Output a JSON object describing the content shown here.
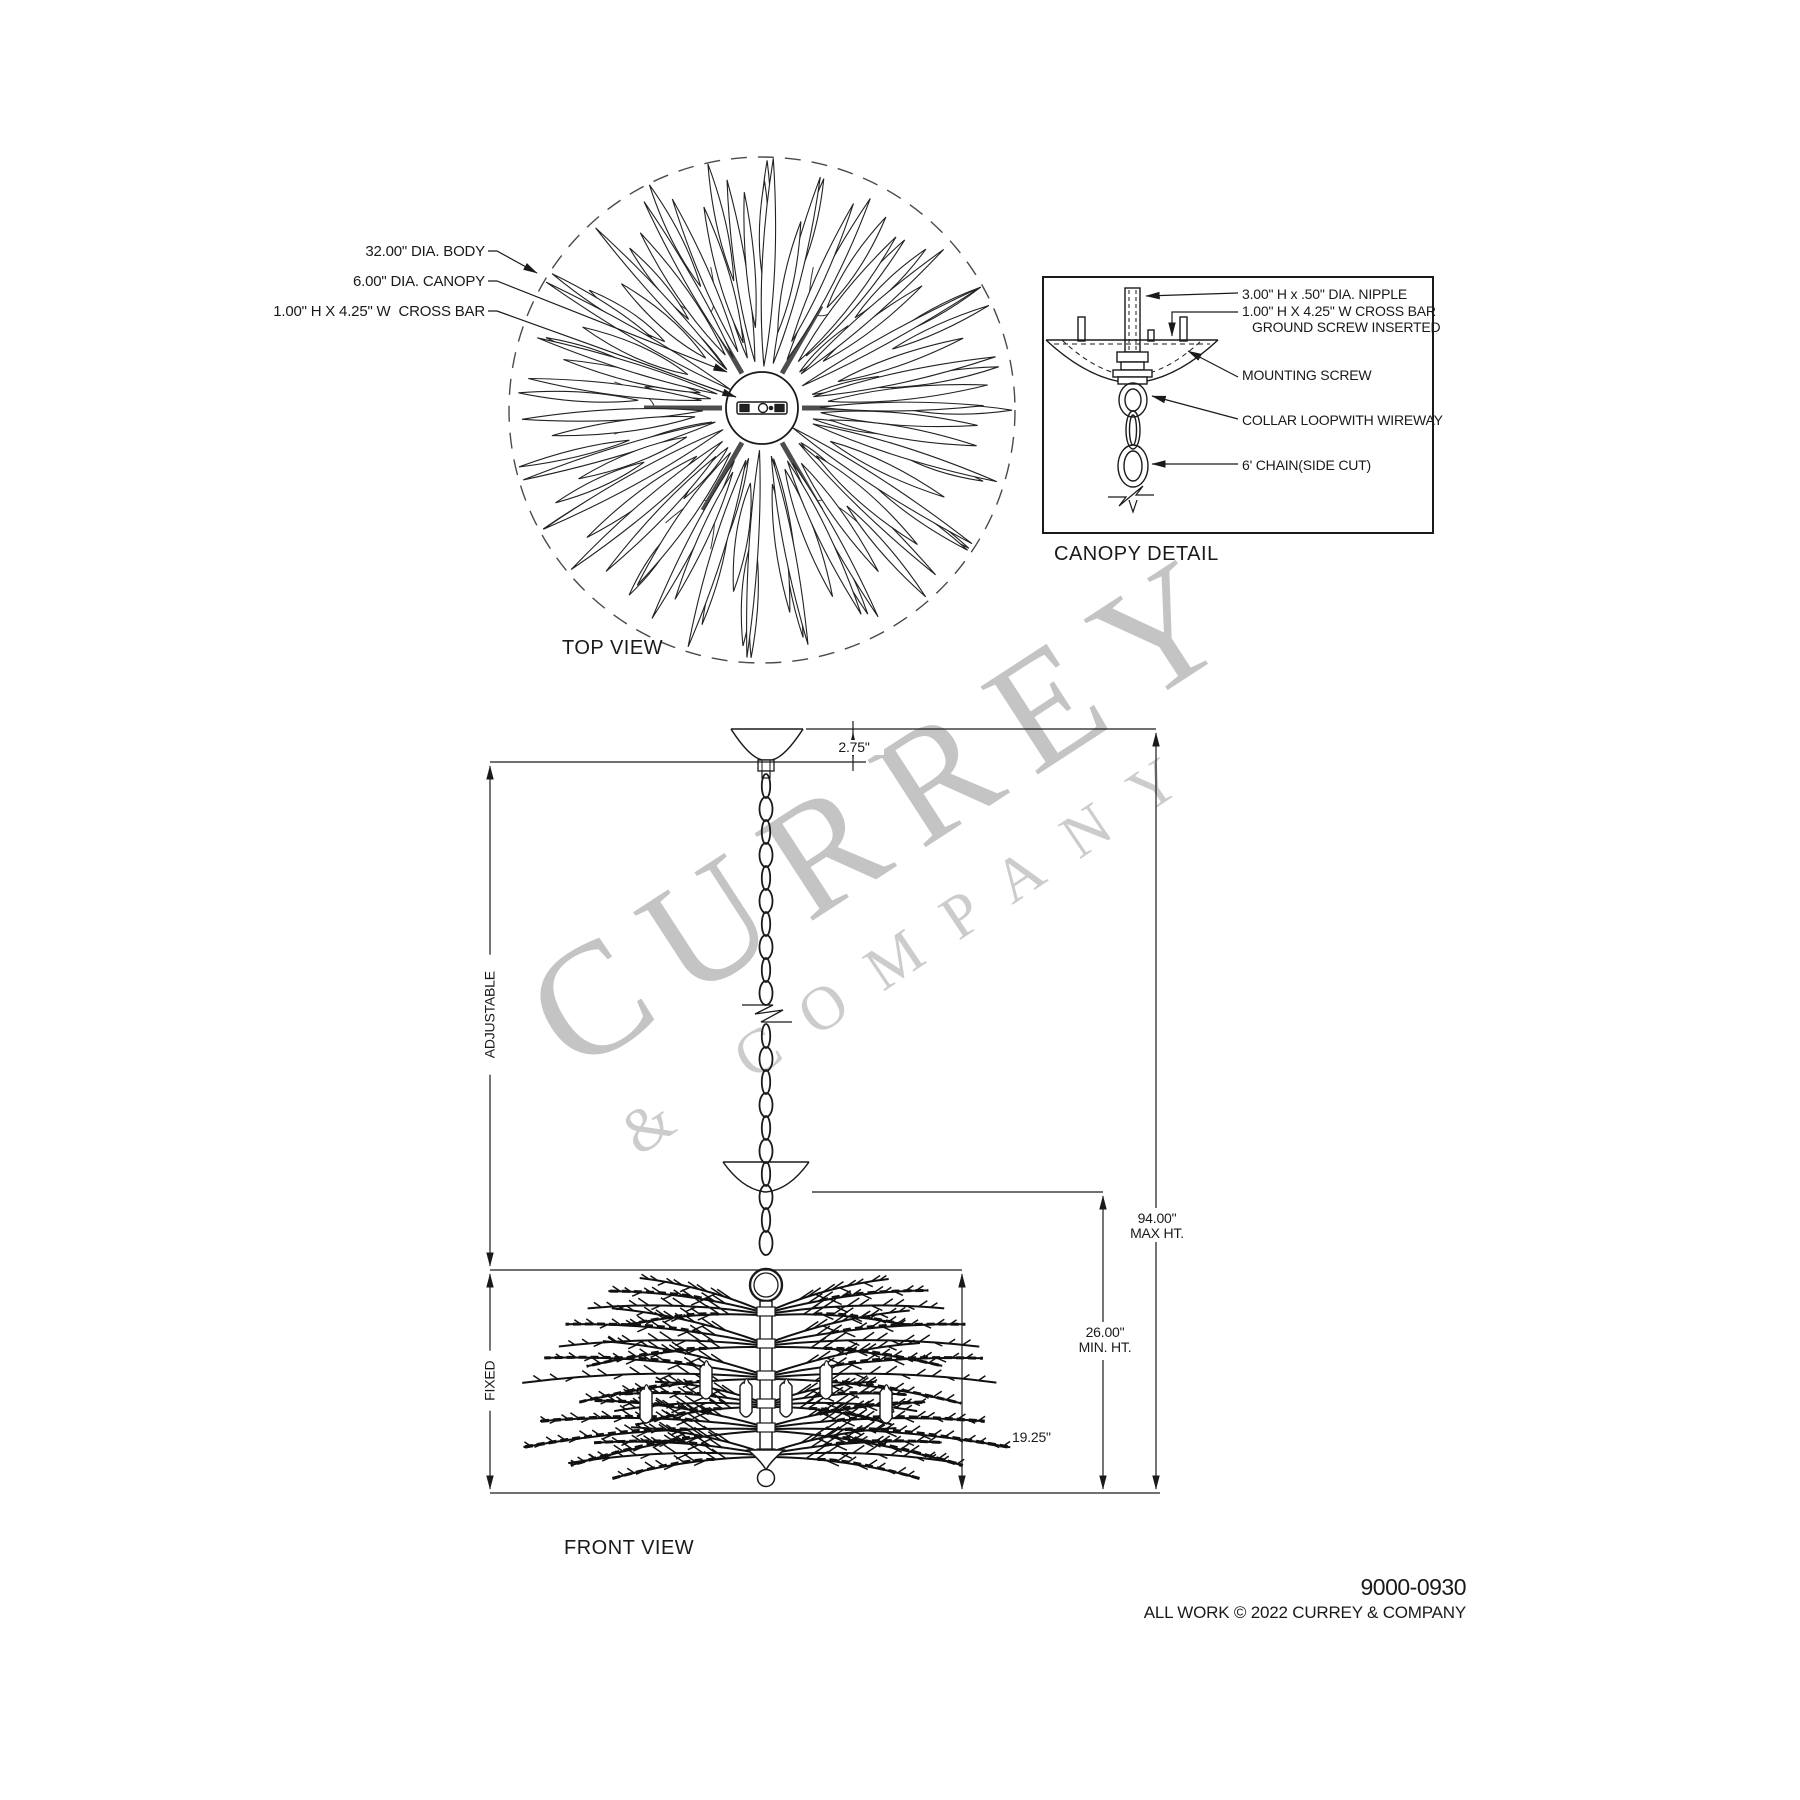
{
  "watermark": {
    "line1": "CURREY",
    "line2": "& COMPANY"
  },
  "top_view": {
    "title": "TOP VIEW",
    "label_body": "32.00\" DIA. BODY",
    "label_canopy": "6.00\" DIA. CANOPY",
    "label_crossbar": "1.00\" H X 4.25\" W  CROSS BAR"
  },
  "canopy_detail": {
    "title": "CANOPY DETAIL",
    "label_nipple": "3.00\" H x .50\" DIA. NIPPLE",
    "label_crossbar_1": "1.00\" H X 4.25'' W CROSS BAR",
    "label_crossbar_2": "GROUND SCREW INSERTED",
    "label_mounting": "MOUNTING SCREW",
    "label_collar": "COLLAR LOOPWITH WIREWAY",
    "label_chain": "6' CHAIN(SIDE CUT)"
  },
  "front_view": {
    "title": "FRONT VIEW",
    "dim_canopy_drop": "2.75\"",
    "dim_max_1": "94.00\"",
    "dim_max_2": "MAX HT.",
    "dim_min_1": "26.00\"",
    "dim_min_2": "MIN. HT.",
    "dim_body": "19.25\"",
    "label_adjustable": "ADJUSTABLE",
    "label_fixed": "FIXED"
  },
  "footer": {
    "model": "9000-0930",
    "copyright": "ALL WORK © 2022 CURREY & COMPANY"
  }
}
